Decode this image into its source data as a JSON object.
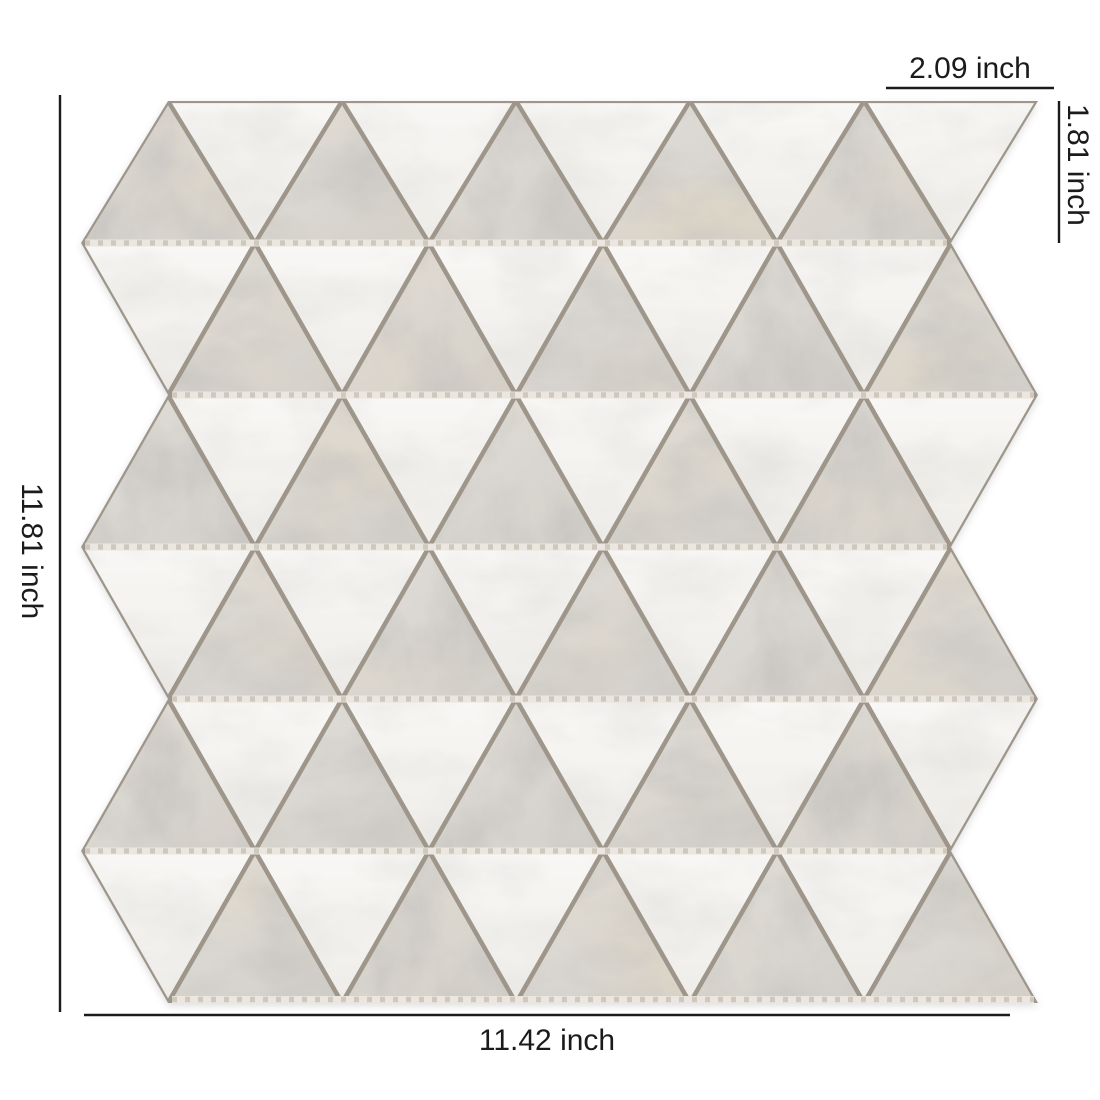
{
  "figure": {
    "kind": "tile product dimension figure",
    "subject": "white and gray carrara triangle marble mosaic sheet"
  },
  "annotations": {
    "triangle_base_label": "2.09 inch",
    "triangle_height_label": "1.81 inch",
    "sheet_height_label": "11.81 inch",
    "sheet_width_label": "11.42 inch",
    "text_color": "#1b1b1b",
    "line_color": "#1b1b1b"
  },
  "dimension_lines": {
    "left": {
      "x1": 60,
      "y1": 95,
      "x2": 60,
      "y2": 1012
    },
    "bottom": {
      "x1": 84,
      "y1": 1015,
      "x2": 1010,
      "y2": 1015
    },
    "right": {
      "x1": 1059,
      "y1": 101,
      "x2": 1059,
      "y2": 243
    },
    "top_underline": {
      "x1": 886,
      "y1": 88,
      "x2": 1054,
      "y2": 88
    }
  },
  "mosaic": {
    "rows": 6,
    "up_triangles_per_row": 5,
    "down_triangles_per_row": 5,
    "up_triangle_material": "gray-carrara-marble",
    "down_triangle_material": "white-marble",
    "x0": 81,
    "base": 174,
    "row_boundaries": [
      101,
      243,
      395,
      547,
      699,
      851,
      1003
    ],
    "shrink": 0.955,
    "colors": {
      "grout": "#9e968b",
      "mesh_base": "#ebe7e0",
      "mesh_dash": "#cfc8bd",
      "white_light": "#f8f7f5",
      "white_dark": "#efede9",
      "gray_light": "#e1ded9",
      "gray_dark": "#d2cfca"
    }
  }
}
